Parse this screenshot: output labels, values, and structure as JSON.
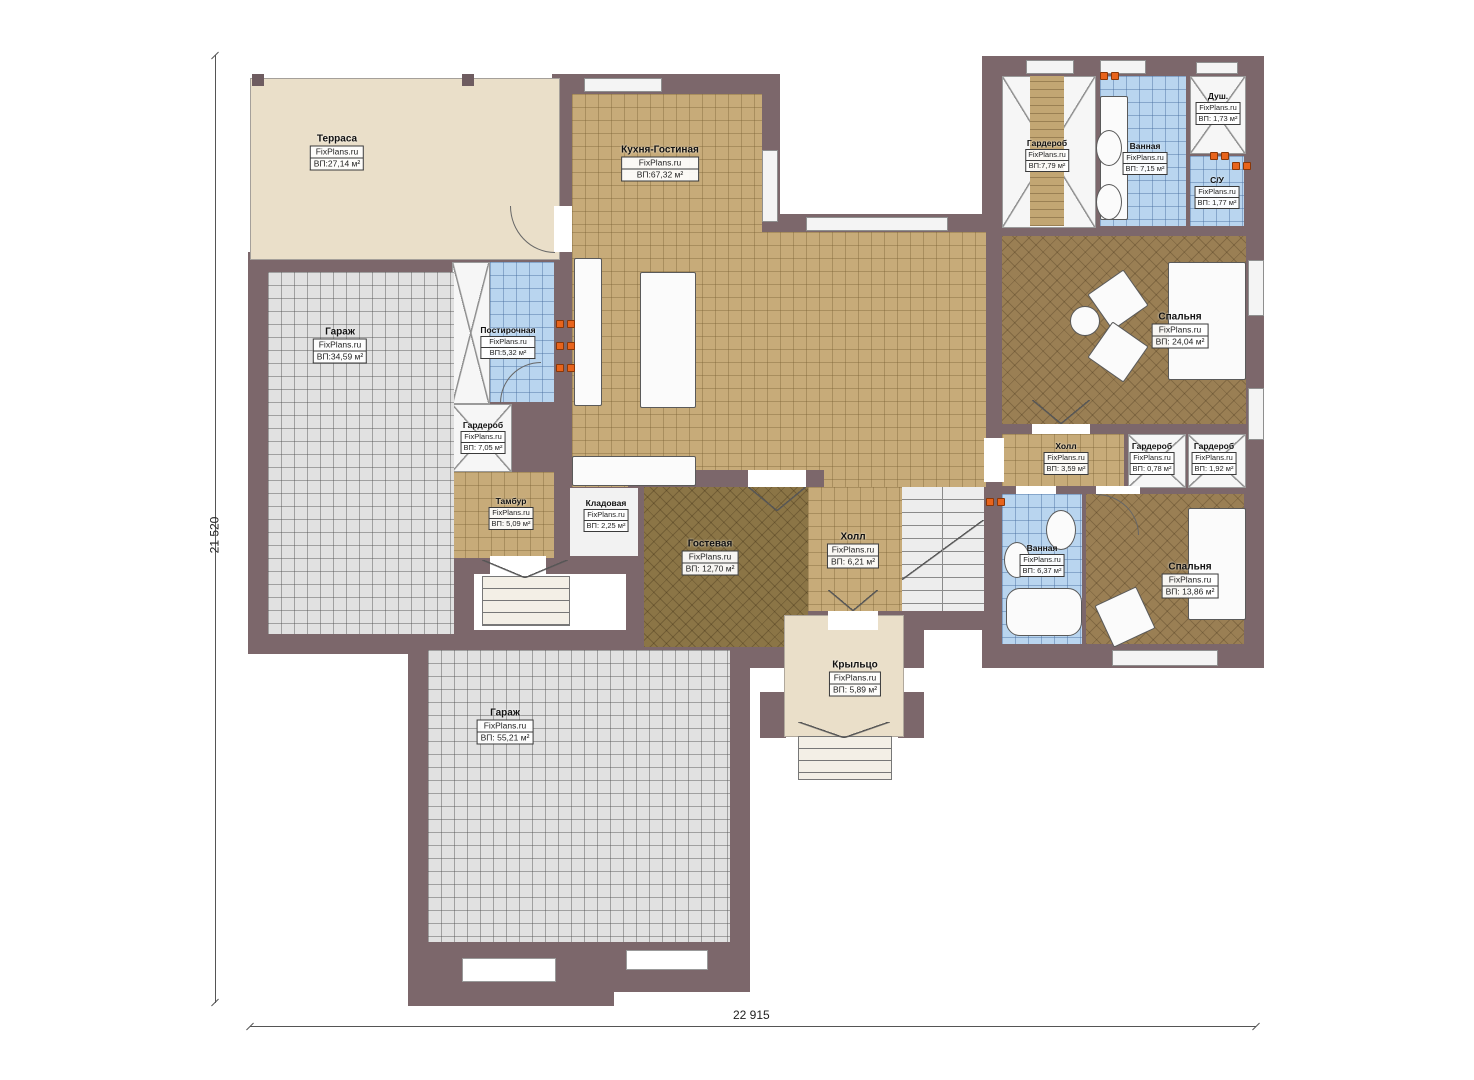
{
  "plan": {
    "brand": "FixPlans.ru",
    "dim_width": "22 915",
    "dim_height": "21 520",
    "rooms": {
      "terrace": {
        "name": "Терраса",
        "area": "ВП:27,14 м²"
      },
      "kitchen": {
        "name": "Кухня-Гостиная",
        "area": "ВП:67,32 м²"
      },
      "garage1": {
        "name": "Гараж",
        "area": "ВП:34,59 м²"
      },
      "laundry": {
        "name": "Постирочная",
        "area": "ВП:5,32 м²"
      },
      "ward705": {
        "name": "Гардероб",
        "area": "ВП: 7,05 м²"
      },
      "tambur": {
        "name": "Тамбур",
        "area": "ВП: 5,09 м²"
      },
      "kladovaya": {
        "name": "Кладовая",
        "area": "ВП: 2,25 м²"
      },
      "guest": {
        "name": "Гостевая",
        "area": "ВП: 12,70 м²"
      },
      "hall_main": {
        "name": "Холл",
        "area": "ВП: 6,21 м²"
      },
      "porch": {
        "name": "Крыльцо",
        "area": "ВП: 5,89 м²"
      },
      "garage2": {
        "name": "Гараж",
        "area": "ВП: 55,21 м²"
      },
      "ward779": {
        "name": "Гардероб",
        "area": "ВП:7,79 м²"
      },
      "bath715": {
        "name": "Ванная",
        "area": "ВП: 7,15 м²"
      },
      "shower": {
        "name": "Душ.",
        "area": "ВП: 1,73 м²"
      },
      "wc": {
        "name": "С/У",
        "area": "ВП: 1,77 м²"
      },
      "bedroom1": {
        "name": "Спальня",
        "area": "ВП: 24,04 м²"
      },
      "hall2": {
        "name": "Холл",
        "area": "ВП: 3,59 м²"
      },
      "ward078": {
        "name": "Гардероб",
        "area": "ВП: 0,78 м²"
      },
      "ward192": {
        "name": "Гардероб",
        "area": "ВП: 1,92 м²"
      },
      "bath637": {
        "name": "Ванная",
        "area": "ВП: 6,37 м²"
      },
      "bedroom2": {
        "name": "Спальня",
        "area": "ВП: 13,86 м²"
      }
    }
  }
}
